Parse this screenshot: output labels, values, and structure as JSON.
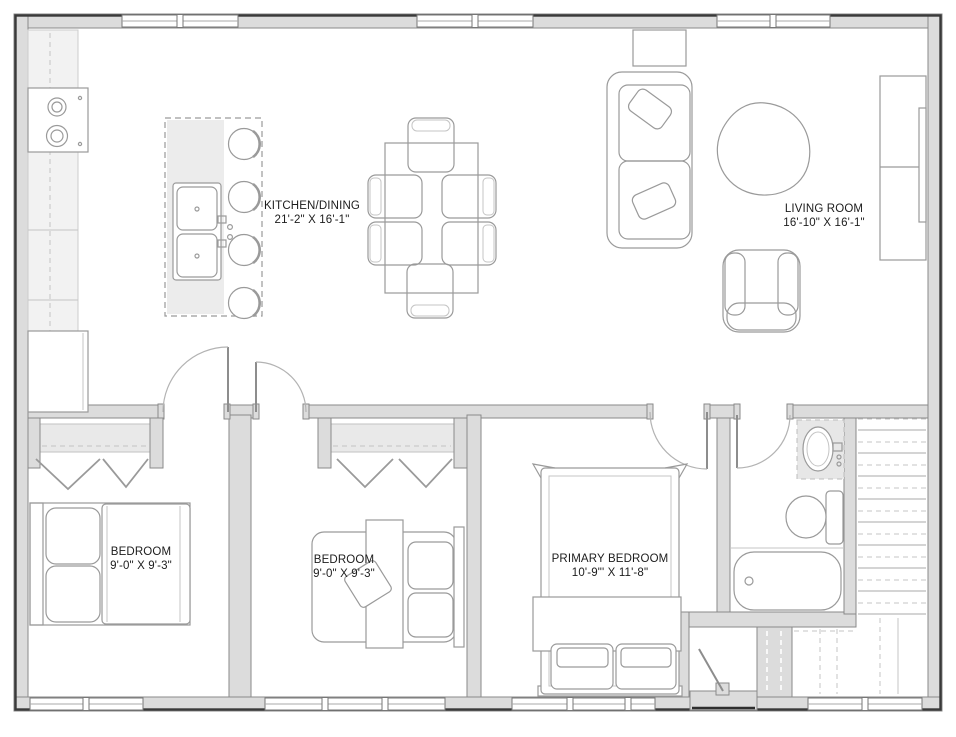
{
  "colors": {
    "wall-fill": "#dcdcdc",
    "wall-stroke": "#8a8a8a",
    "outline": "#3a3a3a",
    "line": "#9a9a9a",
    "line-light": "#c4c4c4",
    "counter": "#f2f2f2",
    "island": "#ececec",
    "closet-shelf": "#e9e9e9",
    "fixture-fill": "#e7e7e7",
    "ink": "#1c1c1c"
  },
  "rooms": [
    {
      "name": "KITCHEN/DINING",
      "dims": "21'-2\" X 16'-1\""
    },
    {
      "name": "LIVING ROOM",
      "dims": "16'-10\" X 16'-1\""
    },
    {
      "name": "BEDROOM",
      "dims": "9'-0\" X 9'-3\""
    },
    {
      "name": "BEDROOM",
      "dims": "9'-0\" X 9'-3\""
    },
    {
      "name": "PRIMARY BEDROOM",
      "dims": "10'-9\"' X 11'-8\""
    }
  ]
}
